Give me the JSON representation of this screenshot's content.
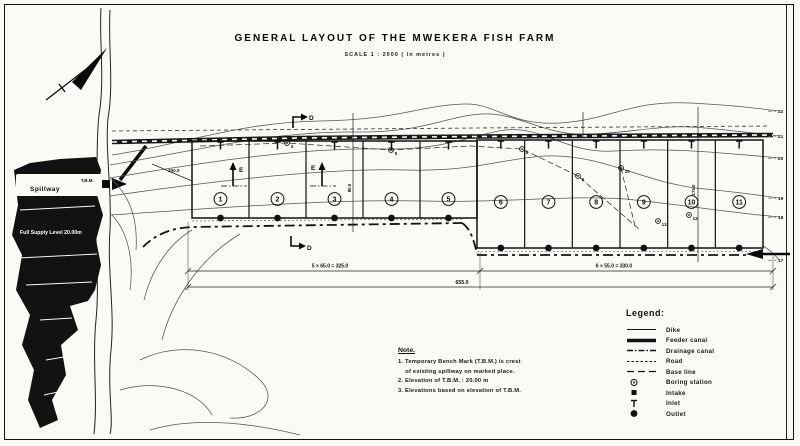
{
  "title": "GENERAL LAYOUT OF THE MWEKERA FISH FARM",
  "subtitle": "SCALE 1 : 2000  ( in metres )",
  "reservoir": {
    "spillway": "Spillway",
    "tbm": "T.B.M.",
    "full_supply": "Full Supply Level 20.00m"
  },
  "pond_groups": [
    {
      "numbers": [
        "1",
        "2",
        "3",
        "4",
        "5"
      ],
      "x0": 192,
      "x1": 477,
      "top": 141,
      "bottom": 218,
      "numY": 199
    },
    {
      "numbers": [
        "6",
        "7",
        "8",
        "9",
        "10",
        "11"
      ],
      "x0": 477,
      "x1": 763,
      "top": 140,
      "bottom": 248,
      "numY": 202
    }
  ],
  "contour_labels": [
    {
      "v": "22",
      "y": 113
    },
    {
      "v": "21",
      "y": 138
    },
    {
      "v": "20",
      "y": 160
    },
    {
      "v": "19",
      "y": 200
    },
    {
      "v": "18",
      "y": 219
    },
    {
      "v": "17",
      "y": 262
    }
  ],
  "stations": [
    {
      "n": "3",
      "x": 287,
      "y": 143
    },
    {
      "n": "5",
      "x": 391,
      "y": 150
    },
    {
      "n": "8",
      "x": 522,
      "y": 149
    },
    {
      "n": "9",
      "x": 578,
      "y": 176
    },
    {
      "n": "10",
      "x": 621,
      "y": 168
    },
    {
      "n": "12",
      "x": 689,
      "y": 215
    },
    {
      "n": "13",
      "x": 658,
      "y": 221
    }
  ],
  "dimensions": {
    "group1": "5 × 65.0 = 325.0",
    "group2": "6 × 55.0 = 330.0",
    "total": "655.0",
    "left_len": "100.0",
    "mid_len": "80.0",
    "right_len": "175.0"
  },
  "section_markers": [
    {
      "label": "D",
      "x": 309,
      "y": 120
    },
    {
      "label": "D",
      "x": 307,
      "y": 250
    },
    {
      "label": "E",
      "x": 239,
      "y": 172
    },
    {
      "label": "E",
      "x": 311,
      "y": 170
    }
  ],
  "legend": {
    "header": "Legend:",
    "items": [
      {
        "symbol": "line-solid",
        "label": "Dike"
      },
      {
        "symbol": "line-thick",
        "label": "Feeder canal"
      },
      {
        "symbol": "line-dashdot",
        "label": "Drainage canal"
      },
      {
        "symbol": "line-dashed",
        "label": "Road"
      },
      {
        "symbol": "line-longdash",
        "label": "Base line"
      },
      {
        "symbol": "boring-station",
        "label": "Boring station"
      },
      {
        "symbol": "intake",
        "label": "Intake"
      },
      {
        "symbol": "inlet",
        "label": "Inlet"
      },
      {
        "symbol": "outlet",
        "label": "Outlet"
      }
    ]
  },
  "notes": {
    "header": "Note.",
    "lines": [
      "1. Temporary Bench Mark (T.B.M.) is crest",
      "    of existing spillway on marked place.",
      "2. Elevation of T.B.M. : 20.00 m",
      "3. Elevations based on elevation of T.B.M."
    ]
  },
  "colors": {
    "ink": "#111111",
    "contour": "#555555",
    "paper": "#fafaf7"
  }
}
